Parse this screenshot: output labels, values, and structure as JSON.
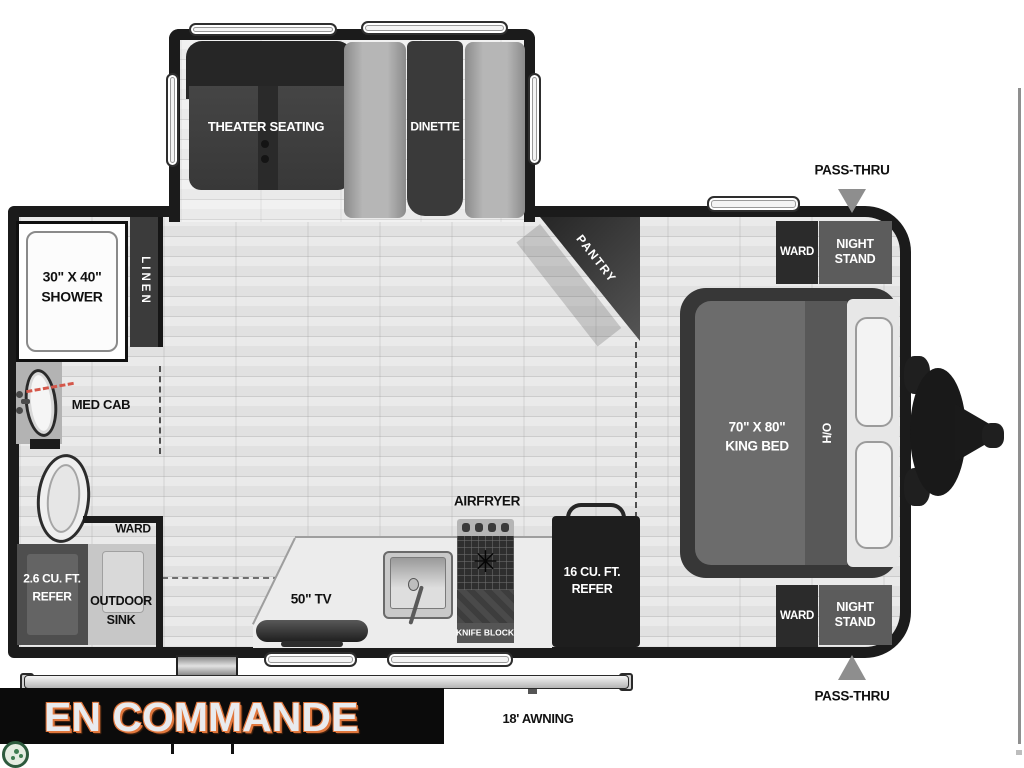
{
  "floorplan": {
    "slideout": {
      "theater": "THEATER SEATING",
      "dinette": "DINETTE"
    },
    "bath": {
      "shower_line1": "30\" X 40\"",
      "shower_line2": "SHOWER",
      "linen": "LINEN",
      "med_cab": "MED CAB"
    },
    "storage": {
      "ward": "WARD",
      "refer_line1": "2.6 CU. FT.",
      "refer_line2": "REFER",
      "outdoor_sink_line1": "OUTDOOR",
      "outdoor_sink_line2": "SINK"
    },
    "kitchen": {
      "tv": "50\" TV",
      "airfryer": "AIRFRYER",
      "knife_block": "KNIFE BLOCK",
      "refer_line1": "16 CU. FT.",
      "refer_line2": "REFER"
    },
    "bedroom": {
      "pantry": "PANTRY",
      "bed_line1": "70\" X 80\"",
      "bed_line2": "KING BED",
      "overhead": "O/H",
      "ward_top": "WARD",
      "ward_bottom": "WARD",
      "night_stand_line1": "NIGHT",
      "night_stand_line2": "STAND",
      "pass_thru_top": "PASS-THRU",
      "pass_thru_bottom": "PASS-THRU"
    },
    "exterior": {
      "awning": "18' AWNING"
    }
  },
  "overlay": {
    "status": "EN COMMANDE"
  },
  "colors": {
    "wall": "#1b1b1b",
    "banner_bg": "#0b0b0b",
    "banner_text": "#e9ebee",
    "banner_accent": "#e0773d",
    "logo_green": "#2d5a3d",
    "arrow_gray": "#8e8e8e",
    "red_dash": "#d4574a"
  }
}
